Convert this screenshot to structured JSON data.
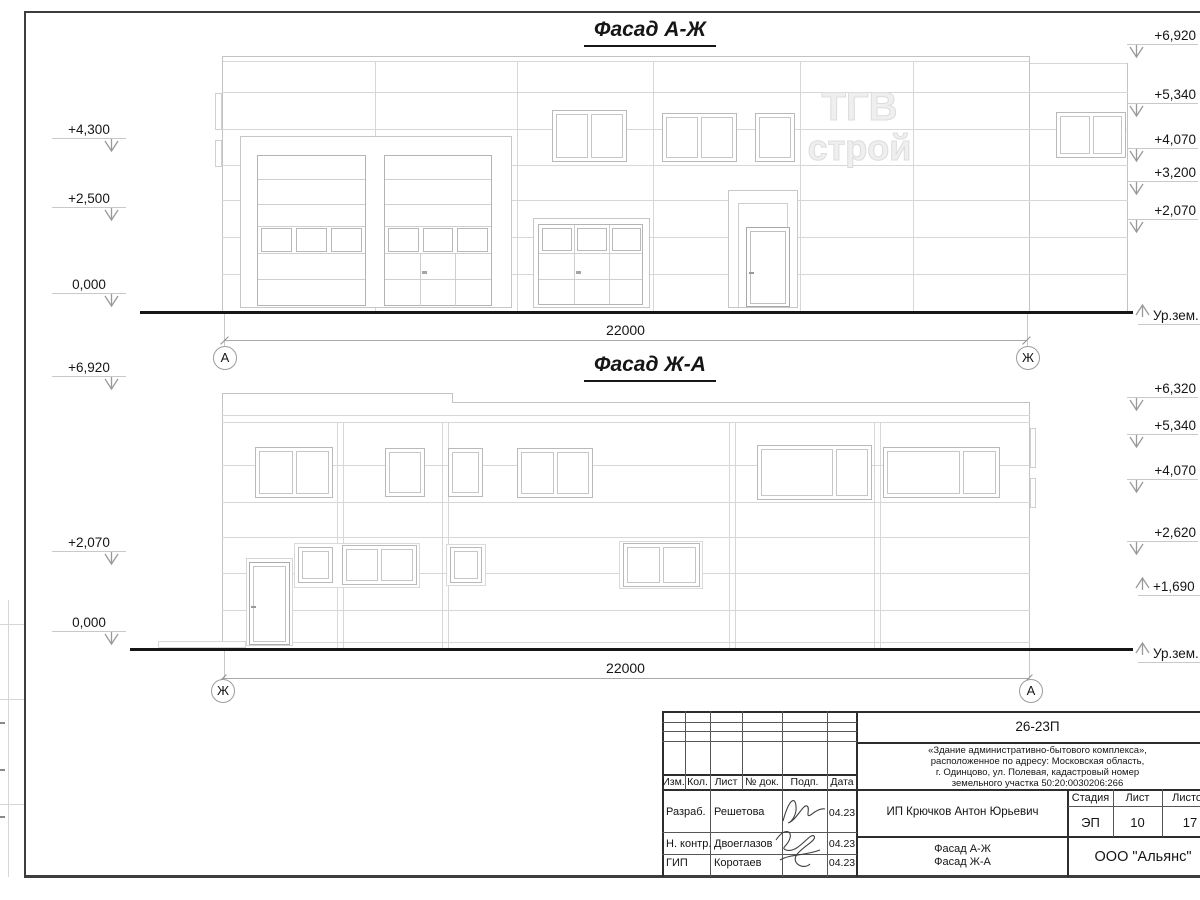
{
  "colors": {
    "drawing_line_light": "#d7d7d7",
    "drawing_line_mid": "#c3c3c3",
    "ground_line": "#161616",
    "frame": "#3d3d3d",
    "text": "#161616",
    "watermark": "#e0e0e0"
  },
  "watermark": {
    "line1": "ТГВ",
    "line2": "строй"
  },
  "facade1": {
    "title": "Фасад А-Ж",
    "dimension": "22000",
    "axis_left": "А",
    "axis_right": "Ж",
    "marks_left": [
      "+4,300",
      "+2,500",
      "0,000"
    ],
    "marks_right": [
      "+6,920",
      "+5,340",
      "+4,070",
      "+3,200",
      "+2,070"
    ],
    "ground_label": "Ур.зем."
  },
  "facade2": {
    "title": "Фасад Ж-А",
    "dimension": "22000",
    "axis_left": "Ж",
    "axis_right": "А",
    "marks_left": [
      "+6,920",
      "+2,070",
      "0,000"
    ],
    "marks_right": [
      "+6,320",
      "+5,340",
      "+4,070",
      "+2,620",
      "+1,690"
    ],
    "ground_label": "Ур.зем."
  },
  "title_block": {
    "doc_number": "26-23П",
    "description": [
      "«Здание административно-бытового комплекса»,",
      "расположенное по адресу: Московская область,",
      "г. Одинцово, ул. Полевая, кадастровый номер",
      "земельного участка 50:20:0030206:266"
    ],
    "header": {
      "izm": "Изм.",
      "kol": "Кол.",
      "list": "Лист",
      "doc": "№ док.",
      "podp": "Подп.",
      "date": "Дата"
    },
    "rows": [
      {
        "role": "Разраб.",
        "name": "Решетова",
        "date": "04.23"
      },
      {
        "role": "Н. контр.",
        "name": "Двоеглазов",
        "date": "04.23"
      },
      {
        "role": "ГИП",
        "name": "Коротаев",
        "date": "04.23"
      }
    ],
    "client": "ИП Крючков Антон Юрьевич",
    "stage_label": "Стадия",
    "stage_value": "ЭП",
    "sheet_label": "Лист",
    "sheet_value": "10",
    "sheets_label": "Листов",
    "sheets_value": "17",
    "sheet_name": [
      "Фасад А-Ж",
      "Фасад Ж-А"
    ],
    "company": "ООО \"Альянс\""
  }
}
